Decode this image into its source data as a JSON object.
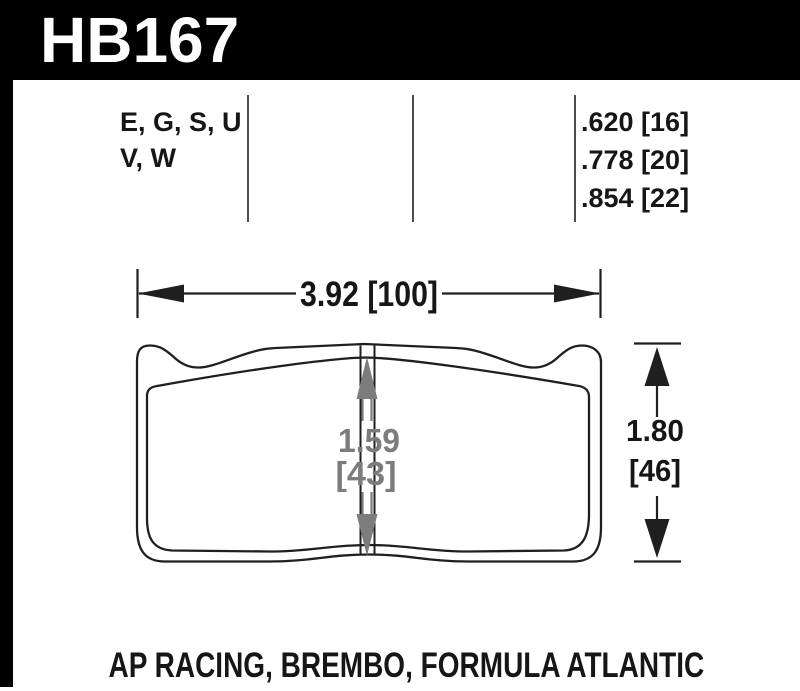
{
  "header": {
    "part_number": "HB167"
  },
  "spec_table": {
    "compound_codes": {
      "line1": "E, G, S, U",
      "line2": "V, W"
    },
    "thicknesses": [
      ".620 [16]",
      ".778 [20]",
      ".854 [22]"
    ]
  },
  "dimensions": {
    "overall_width": "3.92 [100]",
    "pad_height_center": {
      "value": "1.59",
      "bracket": "[43]"
    },
    "overall_height": {
      "value": "1.80",
      "bracket": "[46]"
    }
  },
  "applications": "AP RACING, BREMBO, FORMULA ATLANTIC",
  "colors": {
    "header_bg": "#000000",
    "header_text": "#ffffff",
    "outline": "#1f1f1f",
    "dim_gray": "#7c7c7c"
  }
}
